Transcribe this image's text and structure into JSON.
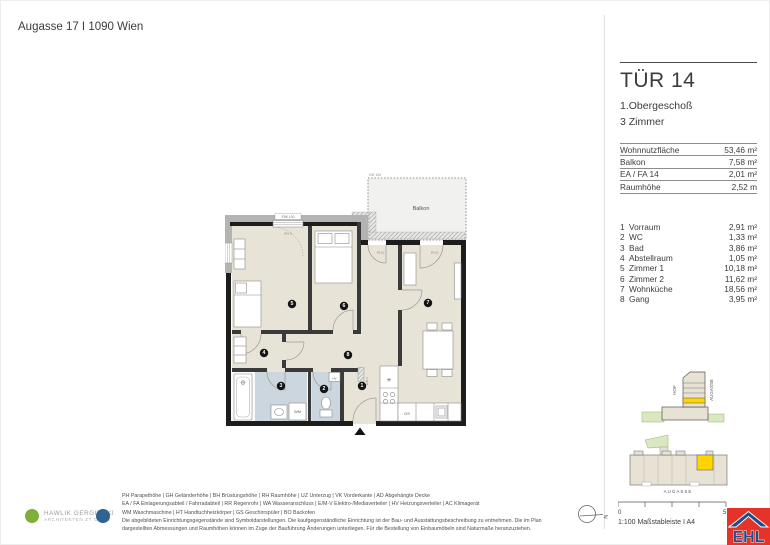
{
  "page": {
    "title": "Augasse 17 I 1090 Wien"
  },
  "unit": {
    "title": "TÜR 14",
    "floor": "1.Obergeschoß",
    "rooms_count": "3 Zimmer",
    "metrics": [
      {
        "label": "Wohnnutzfläche",
        "value": "53,46 m²"
      },
      {
        "label": "Balkon",
        "value": "7,58 m²"
      },
      {
        "label": "EA / FA 14",
        "value": "2,01 m²"
      },
      {
        "label": "Raumhöhe",
        "value": "2,52 m"
      }
    ],
    "rooms": [
      {
        "no": "1",
        "name": "Vorraum",
        "area": "2,91 m²"
      },
      {
        "no": "2",
        "name": "WC",
        "area": "1,33 m²"
      },
      {
        "no": "3",
        "name": "Bad",
        "area": "3,86 m²"
      },
      {
        "no": "4",
        "name": "Abstellraum",
        "area": "1,05 m²"
      },
      {
        "no": "5",
        "name": "Zimmer 1",
        "area": "10,18 m²"
      },
      {
        "no": "6",
        "name": "Zimmer 2",
        "area": "11,62 m²"
      },
      {
        "no": "7",
        "name": "Wohnküche",
        "area": "18,56 m²"
      },
      {
        "no": "8",
        "name": "Gang",
        "area": "3,95 m²"
      }
    ]
  },
  "plan": {
    "labels": {
      "balkon": "Balkon",
      "gh100": "GH 100",
      "fbk100": "FBK 100",
      "ph0": "PH 0",
      "wm": "WM",
      "gs": "GS",
      "hv": "HV",
      "emv": "E/M-V",
      "sink": "✳"
    },
    "badges": [
      "1",
      "2",
      "3",
      "4",
      "5",
      "6",
      "7",
      "8"
    ]
  },
  "site": {
    "hof": "HOF",
    "street_side": "AUGASSE",
    "street_bottom": "AUGASSE",
    "scale_start": "0",
    "scale_end": "5",
    "scale_caption": "1:100 Maßstableiste I A4"
  },
  "compass": {
    "n": "N"
  },
  "footer": {
    "architect_line1": "HAWLIK GERGINSKI",
    "architect_line2": "ARCHITEKTEN ZT GMBH",
    "legend_lines": [
      "PH Parapethöhe | GH Geländerhöhe | BH Brüstungshöhe | RH Raumhöhe | UZ Unterzug | VK Vorderkante | AD Abgehängte Decke",
      "EA / FA Einlagerungsabteil / Fahrradabteil | RR Regenrohr | WA Wasseranschluss | E/M-V Elektro-/Mediaverteiler | HV Heizungsverteiler | AC Klimagerät",
      "WM Waschmaschine | HT Handtuchheizkörper | GS Geschirrspüler | BO Backofen",
      "Die abgebildeten Einrichtungsgegenstände sind Symboldarstellungen. Die kaufgegenständliche Einrichtung ist der Bau- und Ausstattungsbeschreibung zu entnehmen. Die im Plan",
      "dargestellten Abmessungen und Raumhöhen können im Zuge der Bauführung Änderungen unterliegen. Für die Bestellung von Einbaumöbeln sind Naturmaße heranzuziehen."
    ]
  },
  "logo": {
    "ehl": "EHL",
    "reg": "®"
  }
}
